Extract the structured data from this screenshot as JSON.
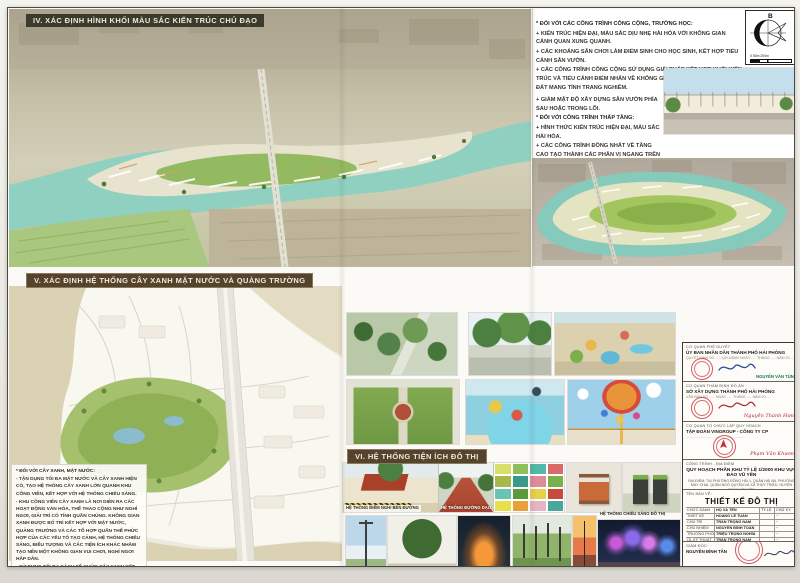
{
  "section_iv": {
    "title": "IV. XÁC ĐỊNH HÌNH KHỐI MÀU SẮC KIẾN TRÚC CHỦ ĐẠO",
    "group_a_title": "* ĐỐI VỚI CÁC CÔNG TRÌNH CÔNG CỘNG, TRƯỜNG HỌC:",
    "group_a": [
      "+ KIẾN TRÚC HIỆN ĐẠI, MÀU SẮC DỊU NHẸ HÀI HÒA VỚI KHÔNG GIAN CẢNH QUAN XUNG QUANH.",
      "+ CÁC KHOẢNG SÂN CHƠI LÀM ĐIỂM SINH CHO HỌC SINH, KẾT HỢP TIỂU CẢNH SÂN VƯỜN.",
      "+ CÁC CÔNG TRÌNH CÔNG CỘNG SỬ DỤNG GIẢI PHÁP KẾT HỢP KHỐI KIẾN TRÚC VÀ TIỂU CẢNH ĐIỂM NHẤN VỀ KHÔNG GIAN TẠO TỔNG THỂ CẢ Ô ĐẤT MANG TÍNH TRANG NGHIÊM."
    ],
    "group_b_lead": "+ GIẢM MẬT ĐỘ XÂY DỰNG SÂN VƯỜN PHÍA SAU HOẶC TRONG LÕI.",
    "group_b_title": "* ĐỐI VỚI CÔNG TRÌNH THẤP TẦNG:",
    "group_b": [
      "+ HÌNH THỨC KIẾN TRÚC HIỆN ĐẠI, MÀU SẮC HÀI HÒA.",
      "+ CÁC CÔNG TRÌNH ĐỒNG NHẤT VỀ TẦNG CAO TẠO THÀNH CÁC PHÂN VỊ NGANG TRÊN MẶT ĐỨNG BẰNG NHAU HÀI HÒA, VỚI CẢNH QUAN XUNG QUANH.",
      "+ KHUYẾN KHÍCH TRỒNG CÂY XANH TRONG KIẾN TRÚC NHÀ.",
      "+ CÔNG TRÌNH NHÀ Ở XÃ HỘI: HÌNH KHỐI KIẾN TRÚC ĐƠN GIẢN, TẠO CÁC KHOẢNG CÂY XANH SÂN CHƠI NỘI BỘ."
    ]
  },
  "compass": {
    "north": "B",
    "scale_ticks": "0   50m        200m"
  },
  "section_v": {
    "title": "V. XÁC ĐỊNH HỆ THỐNG CÂY XANH MẶT NƯỚC VÀ QUẢNG TRƯỜNG",
    "green_title": "* ĐỐI VỚI CÂY XANH, MẶT NƯỚC:",
    "green_notes": [
      "- TẬN DỤNG TỐI ĐA MẶT NƯỚC VÀ CÂY XANH HIỆN CÓ, TẠO HỆ THỐNG CÂY XANH LỚN QUANH KHU CÔNG VIÊN, KẾT HỢP VỚI HỆ THỐNG CHIẾU SÁNG.",
      "- KHU CÔNG VIÊN CÂY XANH LÀ NƠI DIỄN RA CÁC HOẠT ĐỘNG VĂN HÓA, THỂ THAO CỘNG NHƯ NGHỈ NGƠI, GIẢI TRÍ CÓ TÍNH QUẦN CHÚNG. KHÔNG GIAN XANH ĐƯỢC BỐ TRÍ KẾT HỢP VỚI MẶT NƯỚC, QUẢNG TRƯỜNG VÀ CÁC TỔ HỢP QUẦN THỂ PHỨC HỢP CỦA CÁC YẾU TỐ TẠO CẢNH, HỆ THỐNG CHIẾU SÁNG, BIỂU TƯỢNG VÀ CÁC TIỆN ÍCH KHÁC NHẰM TẠO NÊN MỘT KHÔNG GIAN VUI CHƠI, NGHỈ NGƠI HẤP DẪN.",
      "- SỬ DỤNG TỐI ĐA CÁCH TỔ CHỨC CÂY XANH KẾT HỢP VỚI QUẢNG TRƯỜNG ĐỂ TẠO ĐƯỢC NHIỀU KHÔNG GIAN SÂN CỎ BÓNG MÁT PHỤC VỤ CHO CỘNG ĐỒNG."
    ]
  },
  "section_vi": {
    "title": "VI. HỆ THỐNG TIỆN ÍCH ĐÔ THỊ",
    "caption_rest_stop": "HỆ THỐNG ĐIỂM NGHỈ BÊN ĐƯỜNG",
    "caption_walkway": "HỆ THỐNG ĐƯỜNG DẠO",
    "caption_lighting": "HỆ THỐNG CHIẾU SÁNG ĐÔ THỊ",
    "swatches": [
      "#d9e06a",
      "#8fbf5a",
      "#52b8a8",
      "#d96a6a",
      "#a8b84a",
      "#3a9a8a",
      "#e08a9a",
      "#7ab04a",
      "#6ac4b4",
      "#5a9a3a",
      "#e8d04a",
      "#c84a3a",
      "#e8e04a",
      "#e8a03a",
      "#e8b4c4",
      "#4aa89a"
    ]
  },
  "title_block": {
    "approval": {
      "label": "CƠ QUAN PHÊ DUYỆT",
      "org": "ỦY BAN NHÂN DÂN THÀNH PHỐ HẢI PHÒNG",
      "note": "QUYẾT ĐỊNH SỐ ....../QĐ-UBND NGÀY ..... THÁNG ..... NĂM 20.....",
      "signer": "NGUYỄN VĂN TÙNG"
    },
    "appraisal": {
      "label": "CƠ QUAN THẨM ĐỊNH ĐỒ ÁN",
      "org": "SỞ XÂY DỰNG THÀNH PHỐ HẢI PHÒNG",
      "note": "VĂN BẢN SỐ ...... NGÀY ..... THÁNG ..... NĂM 20.....",
      "signer": "Nguyễn Thành Hưng"
    },
    "organizer": {
      "label": "CƠ QUAN TỔ CHỨC LẬP QUY HOẠCH",
      "org": "TẬP ĐOÀN VINGROUP - CÔNG TY CP",
      "note": "..........................................................",
      "signer": "Phạm Văn Khương"
    },
    "project": {
      "label": "CÔNG TRÌNH - ĐỊA ĐIỂM",
      "name": "QUY HOẠCH PHÂN KHU TỶ LỆ 1/2000 KHU VỰC ĐẢO VŨ YÊN",
      "location": "ĐỊA ĐIỂM: TẠI PHƯỜNG ĐÔNG HẢI 1, QUẬN HẢI AN, PHƯỜNG MÁY CHAI, QUẬN NGÔ QUYỀN VÀ XÃ THỦY TRIỀU, HUYỆN THỦY NGUYÊN"
    },
    "drawing": {
      "name_label": "TÊN BẢN VẼ:",
      "title": "THIẾT KẾ ĐÔ THỊ",
      "col_role": "CHỨC DANH",
      "col_name": "HỌ VÀ TÊN",
      "col_scale": "TỶ LỆ",
      "col_sign": "CHỮ KÝ",
      "rows": [
        {
          "role": "THIẾT KẾ",
          "name": "HOÀNG LÊ TUẤN"
        },
        {
          "role": "CHỦ TRÌ",
          "name": "TRẦN TRỌNG NAM"
        },
        {
          "role": "CHỦ NHIỆM",
          "name": "NGUYỄN ĐÌNH TOÀN"
        },
        {
          "role": "TRƯỞNG PHÒNG",
          "name": "TRIỆU TRỌNG NGHĨA"
        },
        {
          "role": "QL KỸ THUẬT",
          "name": "TRẦN TRỌNG NAM"
        }
      ],
      "director_label": "GIÁM ĐỐC:",
      "director": "NGUYỄN ĐÌNH TÂN"
    },
    "company": {
      "logo": "VUD",
      "name": "CÔNG TY CỔ PHẦN TƯ VẤN PHÁT TRIỂN ĐÔ THỊ VIỆT NAM",
      "address": "ĐỊA CHỈ: TP. HÀ NỘI - TEL: .......... - WEBSITE: ..........."
    }
  }
}
